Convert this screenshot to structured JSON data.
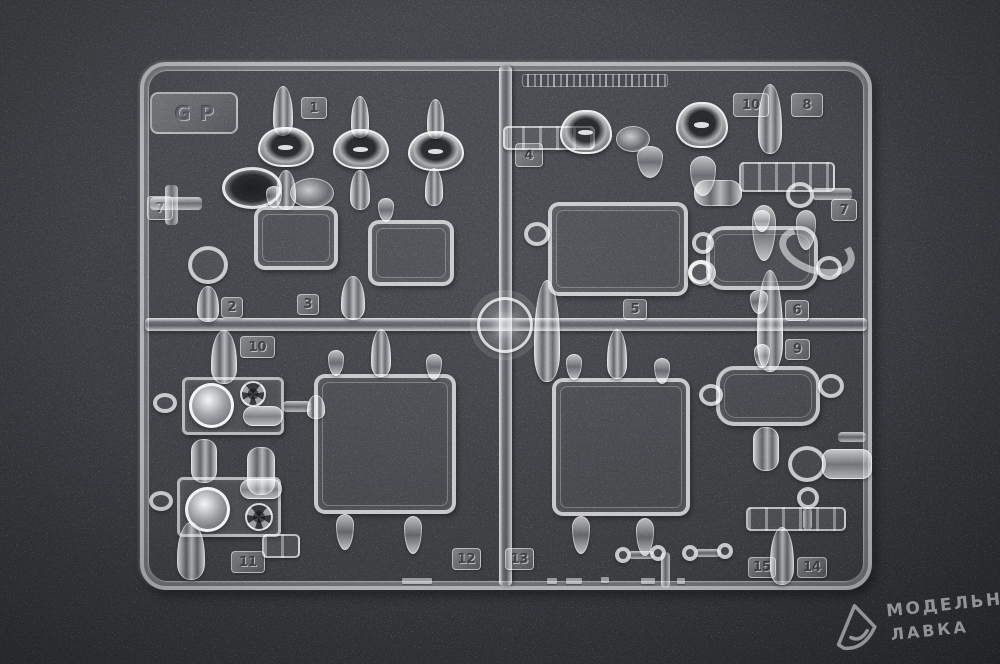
{
  "sprue": {
    "corner_code": "GP",
    "tags": [
      {
        "label": "1"
      },
      {
        "label": "10"
      },
      {
        "label": "8"
      },
      {
        "label": "4"
      },
      {
        "label": "7"
      },
      {
        "label": "7"
      },
      {
        "label": "2"
      },
      {
        "label": "3"
      },
      {
        "label": "10"
      },
      {
        "label": "5"
      },
      {
        "label": "6"
      },
      {
        "label": "9"
      },
      {
        "label": "11"
      },
      {
        "label": "12"
      },
      {
        "label": "13"
      },
      {
        "label": "15"
      },
      {
        "label": "14"
      }
    ]
  },
  "watermark": {
    "line1": "МОДЕЛЬНАЯ",
    "line2": "ЛАВКА"
  },
  "colors": {
    "background": "#3a3d40",
    "plastic": "#f2f4f6",
    "watermark_text": "#d8dadc"
  }
}
